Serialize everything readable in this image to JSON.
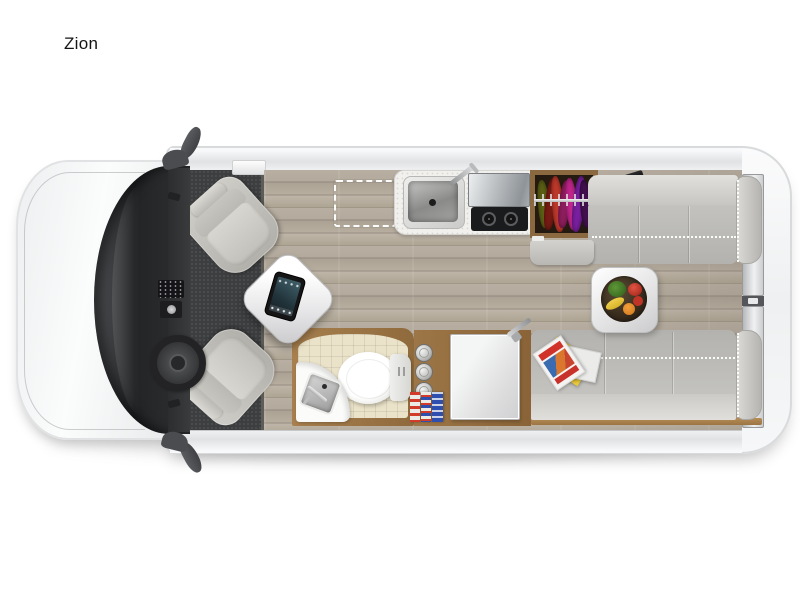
{
  "title": {
    "label": "Zion"
  },
  "colors": {
    "background": "#ffffff",
    "text": "#141414",
    "carpet": "#3d3e40",
    "wood_floor": "#b3aa9d",
    "wood_trim": "#9c7646",
    "sofa": "#b3b2ae",
    "counter": "#f1f0ed",
    "tile": "#ebe3c9",
    "cooktop": "#1a1b1c",
    "wardrobe_wood": "#8a6840"
  },
  "wardrobe": {
    "clothes_colors": [
      "#5c6114",
      "#7a1b14",
      "#c0392b",
      "#8e1d5e",
      "#c2268c",
      "#7a1fa0",
      "#43104f"
    ]
  },
  "legend": {
    "components": [
      "cab-with-swivel-seats",
      "pedestal-table-with-tablet",
      "galley-sink",
      "two-burner-cooktop",
      "wardrobe-with-clothes",
      "tv-on-swivel-arm",
      "rear-sofa-curbside",
      "rear-sofa-roadside",
      "removable-rear-table",
      "bathroom-with-toilet-and-sink",
      "pantry-shelf",
      "refrigerator",
      "optional-floor-area-dashed",
      "fold-out-bed-dotted-lines",
      "rear-double-doors"
    ]
  }
}
